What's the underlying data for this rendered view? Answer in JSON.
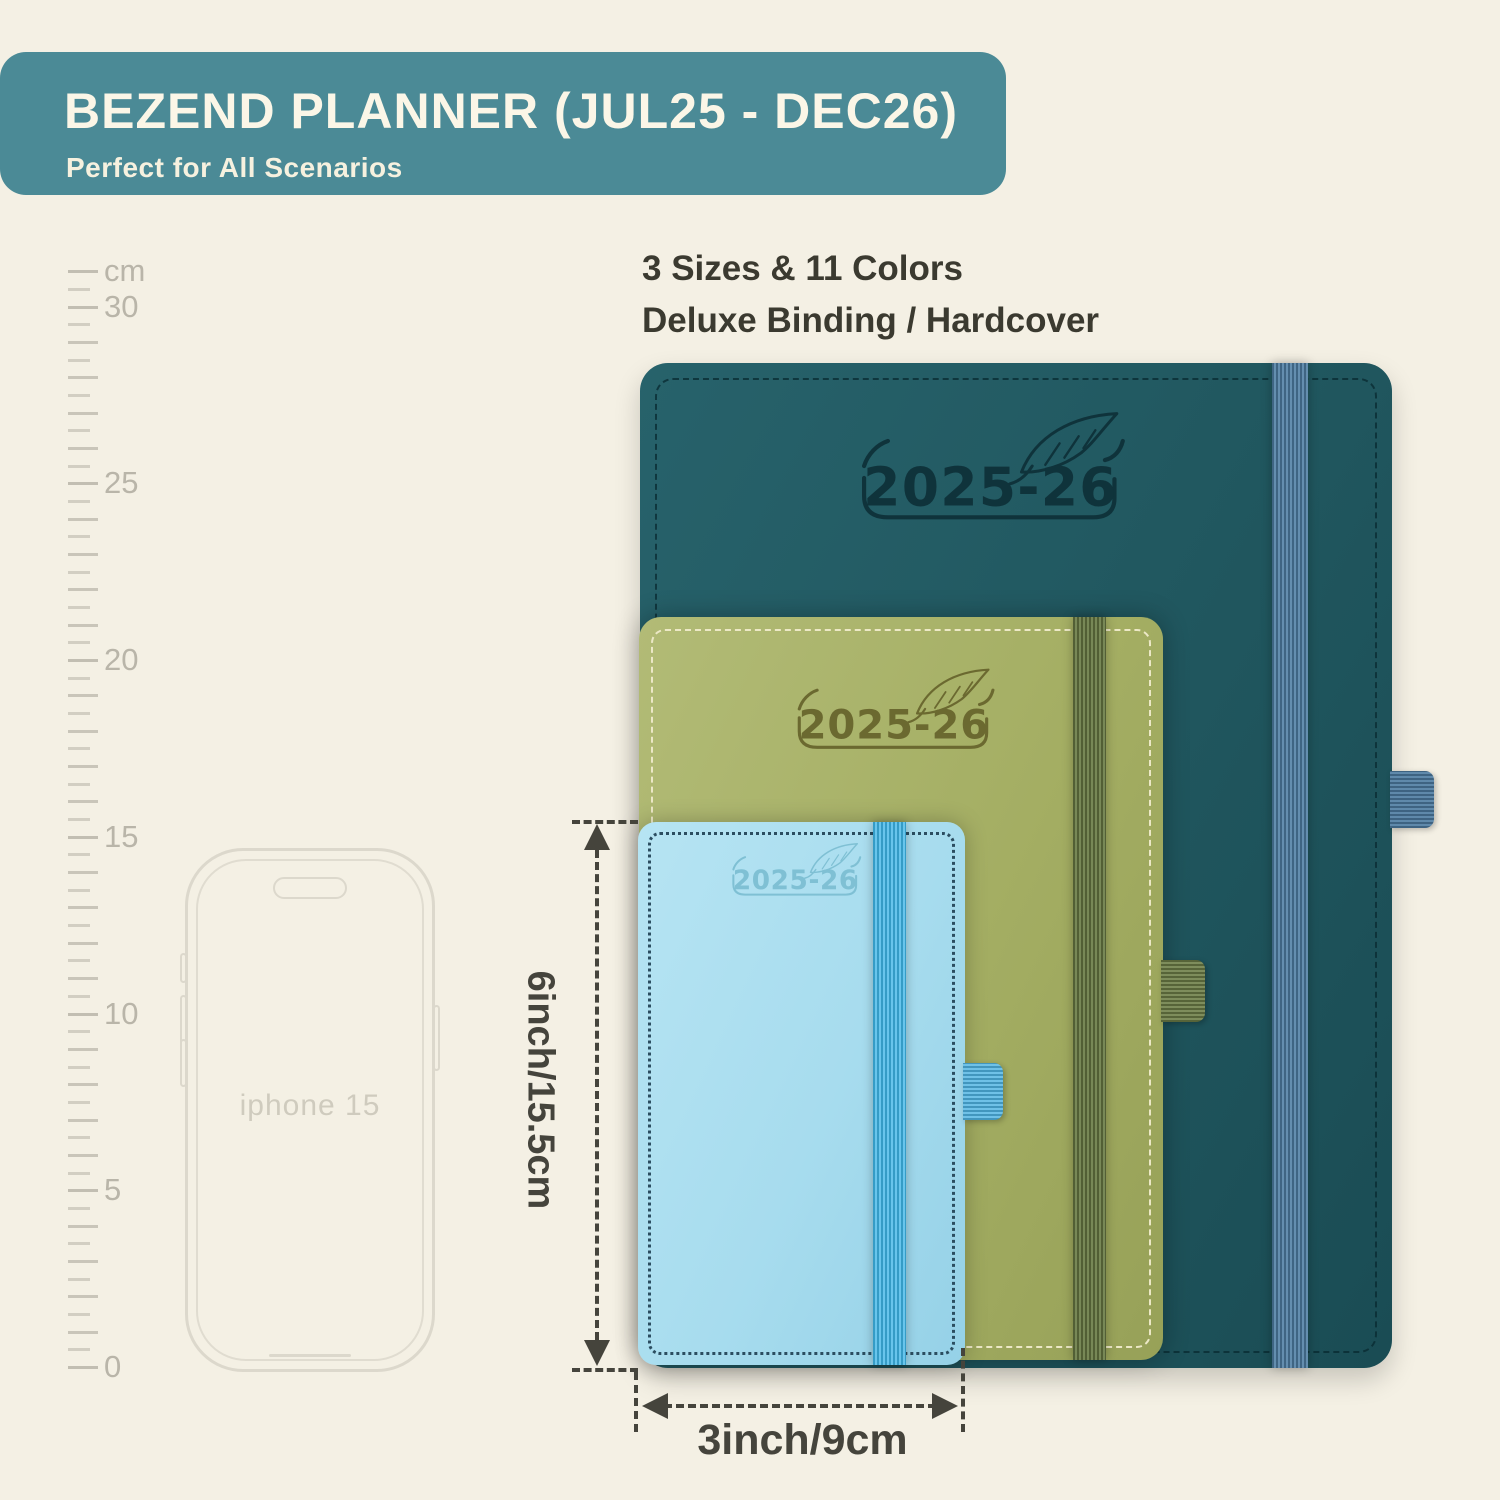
{
  "banner": {
    "title": "BEZEND PLANNER (JUL25 - DEC26)",
    "subtitle": "Perfect for All Scenarios",
    "bg_color": "#4b8a96",
    "text_color": "#fbf6e7"
  },
  "features": {
    "line1": "3 Sizes & 11 Colors",
    "line2": "Deluxe Binding / Hardcover"
  },
  "ruler": {
    "unit": "cm",
    "marks": [
      {
        "cm": 31,
        "label": "cm"
      },
      {
        "cm": 30,
        "label": "30"
      },
      {
        "cm": 25,
        "label": "25"
      },
      {
        "cm": 20,
        "label": "20"
      },
      {
        "cm": 15,
        "label": "15"
      },
      {
        "cm": 10,
        "label": "10"
      },
      {
        "cm": 5,
        "label": "5"
      },
      {
        "cm": 0,
        "label": "0"
      }
    ]
  },
  "phone": {
    "label": "iphone 15"
  },
  "planners": [
    {
      "size": "large",
      "year": "2025-26",
      "cover_color": "#215860",
      "band_color": "#4f7ea4",
      "logo_color": "#0f333b"
    },
    {
      "size": "medium",
      "year": "2025-26",
      "cover_color": "#a4ae63",
      "band_color": "#697a44",
      "logo_color": "#6b6930"
    },
    {
      "size": "small",
      "year": "2025-26",
      "cover_color": "#a7dcee",
      "band_color": "#3eb5e7",
      "logo_color": "#7fc0d4"
    }
  ],
  "dimensions": {
    "height": "6inch/15.5cm",
    "width": "3inch/9cm"
  },
  "colors": {
    "background": "#f4f0e4",
    "annotation": "#45443c",
    "ruler": "#c9c5b9"
  }
}
